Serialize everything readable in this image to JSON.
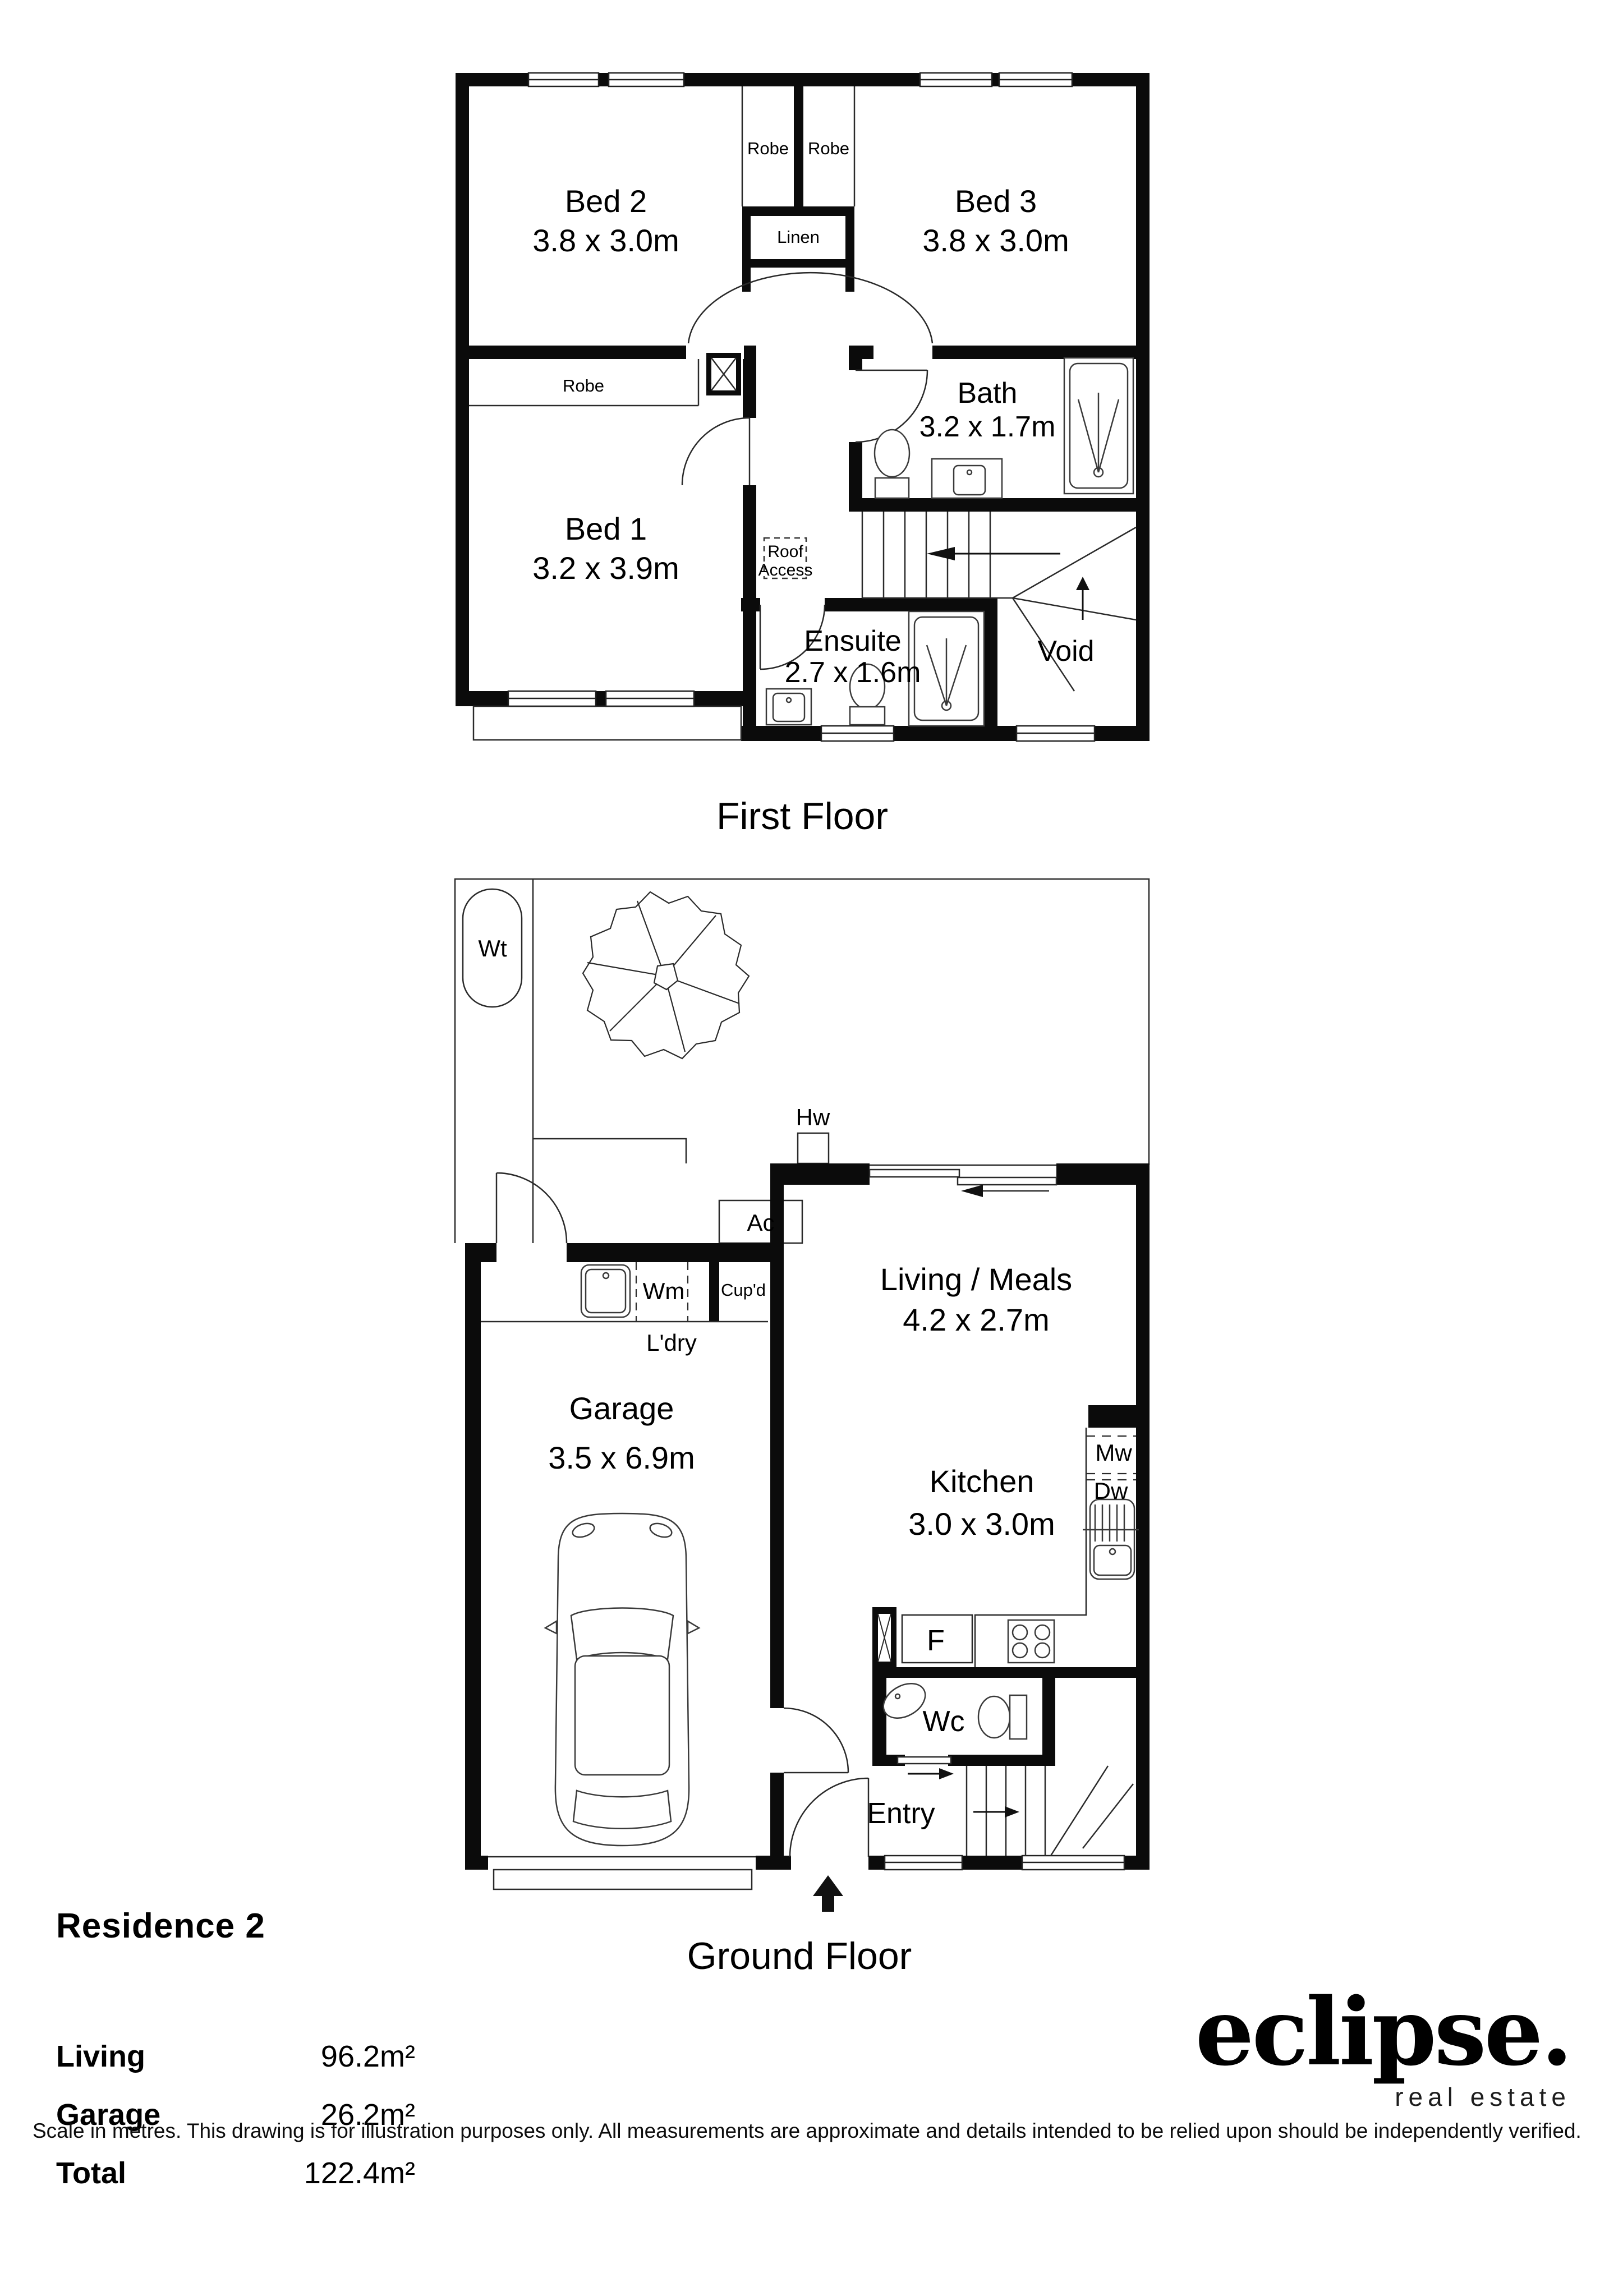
{
  "first_floor": {
    "title": "First Floor",
    "rooms": {
      "bed2": {
        "name": "Bed 2",
        "dims": "3.8 x 3.0m"
      },
      "bed3": {
        "name": "Bed 3",
        "dims": "3.8 x 3.0m"
      },
      "bed1": {
        "name": "Bed 1",
        "dims": "3.2 x 3.9m"
      },
      "bath": {
        "name": "Bath",
        "dims": "3.2 x 1.7m"
      },
      "ensuite": {
        "name": "Ensuite",
        "dims": "2.7 x 1.6m"
      }
    },
    "labels": {
      "robe_left": "Robe",
      "robe_right": "Robe",
      "linen": "Linen",
      "robe_bed1": "Robe",
      "roof_access_line1": "Roof",
      "roof_access_line2": "Access",
      "void": "Void"
    }
  },
  "ground_floor": {
    "title": "Ground Floor",
    "rooms": {
      "garage": {
        "name": "Garage",
        "dims": "3.5 x 6.9m"
      },
      "living": {
        "name": "Living / Meals",
        "dims": "4.2 x 2.7m"
      },
      "kitchen": {
        "name": "Kitchen",
        "dims": "3.0 x 3.0m"
      }
    },
    "labels": {
      "wt": "Wt",
      "hw": "Hw",
      "ac": "Ac",
      "wm": "Wm",
      "cupd": "Cup'd",
      "ldry": "L'dry",
      "mw": "Mw",
      "dw": "Dw",
      "fridge": "F",
      "wc": "Wc",
      "entry": "Entry"
    }
  },
  "info": {
    "residence": "Residence 2",
    "areas": [
      {
        "label": "Living",
        "value": "96.2m²"
      },
      {
        "label": "Garage",
        "value": "26.2m²"
      },
      {
        "label": "Total",
        "value": "122.4m²"
      }
    ]
  },
  "logo": {
    "brand": "eclipse.",
    "tagline": "real estate"
  },
  "footer": {
    "disclaimer": "Scale in metres. This drawing is for illustration purposes only. All measurements are approximate and details intended to be relied upon should be independently verified."
  }
}
